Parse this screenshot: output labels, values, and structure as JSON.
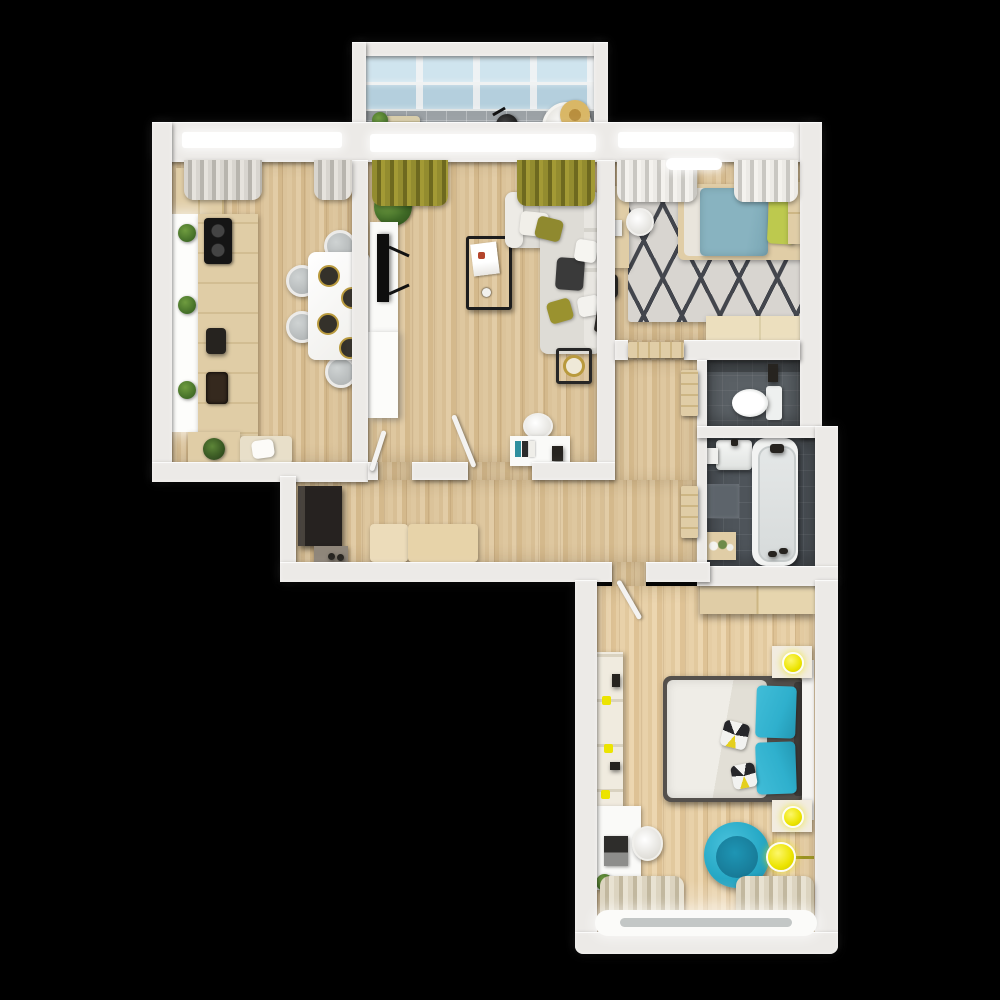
{
  "meta": {
    "width": 1000,
    "height": 1000,
    "view": "top-down 3d apartment floor plan render",
    "background": "#000000"
  },
  "palette": {
    "wall": "#eceae7",
    "wall_shadow": "#cfccc7",
    "wood_a": "#dec79f",
    "wood_b": "#d4b98c",
    "balcony_tile": "#9ba1a5",
    "glass_top": "#cfe4ee",
    "glass_bottom": "#b4cfdd",
    "bath_tile": "#4e545a",
    "wc_tile": "#5a6065",
    "sofa_gray": "#dedcd6",
    "olive": "#8f892f",
    "olive_dark": "#6e691f",
    "teal": "#2fb0cd",
    "teal_soft": "#88b3c0",
    "yellow": "#ece400",
    "kid_pillow": "#bdc94e",
    "furniture_wood": "#e0cda6",
    "furniture_wood_light": "#ecdfbe",
    "dark_wood": "#2b2723",
    "rug_base": "#d8d5d0",
    "rug_dark": "#43464d",
    "white": "#fafaf8",
    "plant_green": "#3f6a26",
    "gold": "#b99a3e"
  },
  "rooms": [
    {
      "id": "balcony-top",
      "name": "Glazed balcony with skylight roof"
    },
    {
      "id": "kitchen-dining",
      "name": "Kitchen / dining room"
    },
    {
      "id": "living-room",
      "name": "Living room"
    },
    {
      "id": "kids-bedroom",
      "name": "Kids bedroom"
    },
    {
      "id": "wc",
      "name": "WC"
    },
    {
      "id": "bathroom",
      "name": "Bathroom"
    },
    {
      "id": "hallway",
      "name": "Hallway / corridor"
    },
    {
      "id": "master-bedroom",
      "name": "Master bedroom"
    }
  ],
  "furniture": {
    "balcony": [
      "storage crate with plant",
      "kettle",
      "round chair with straw hat"
    ],
    "kitchen": [
      "upper cabinet",
      "lit countertop with three plants",
      "cooktop",
      "coffee machine",
      "sink",
      "bench with plant pot",
      "white dining table",
      "four round chairs",
      "four dark place settings with gold rims",
      "gray curtains"
    ],
    "living_room": [
      "olive curtains",
      "potted plant",
      "tv console with black tv",
      "tall white cabinet",
      "black coffee table with magazines",
      "gray corner sofa with olive and white pillows",
      "wall shelf with frames",
      "floor clock with gold dial",
      "desk with chair and books"
    ],
    "kids_bedroom": [
      "light curtains",
      "ceiling light",
      "single bed with teal duvet",
      "green-yellow pillow",
      "geometric gray rug",
      "wood wardrobe",
      "desk with white chair and laptop",
      "wood dresser",
      "dark backpack"
    ],
    "wc": [
      "toilet",
      "wall plumbing"
    ],
    "bathroom": [
      "washbasin",
      "bathtub with dark faucet",
      "light bath mat",
      "wood shelf with toiletries",
      "dark slippers"
    ],
    "hallway": [
      "dark wardrobe",
      "shoe cabinet with shoes",
      "two-part wood bench",
      "white interior door leaves",
      "wood doors to wc and bathroom"
    ],
    "master_bedroom": [
      "sliding wood wardrobe",
      "double bed with white duvet and teal pillows",
      "patterned accent pillows",
      "two nightstands with yellow lamps",
      "wall shelf with yellow decor",
      "white desk with laptop and chair",
      "teal egg chair",
      "yellow floor lamp",
      "striped curtains",
      "bright window sill"
    ]
  }
}
